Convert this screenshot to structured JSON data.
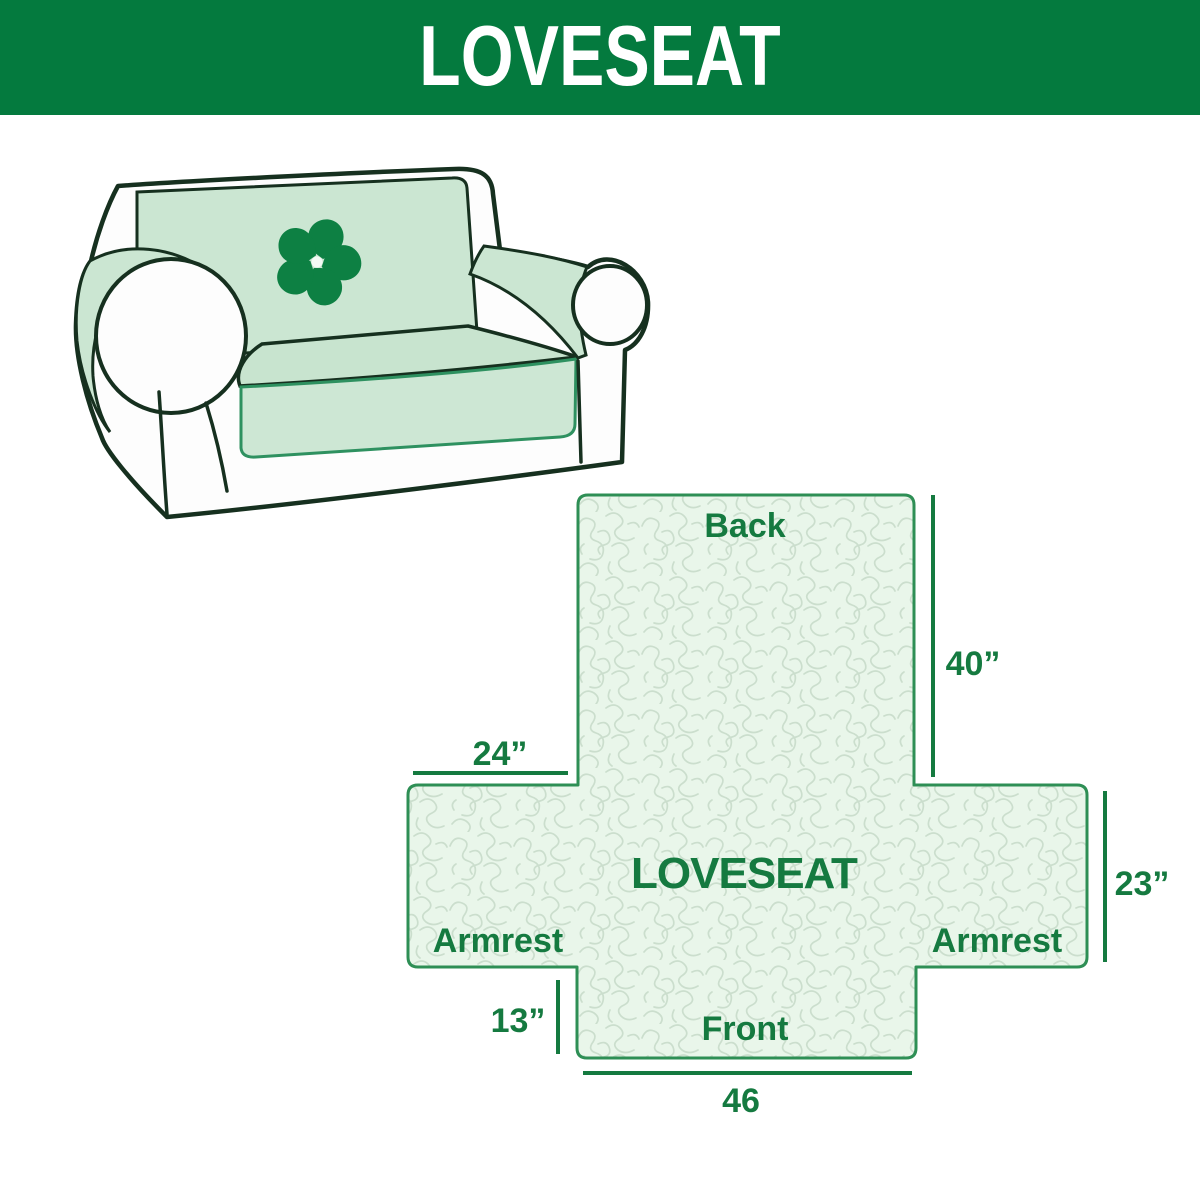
{
  "header": {
    "title": "LOVESEAT"
  },
  "illustration": {
    "alt": "loveseat sofa with mint protective slipcover",
    "logo_icon": "pinwheel-icon"
  },
  "diagram": {
    "back_label": "Back",
    "center_label": "LOVESEAT",
    "armrest_left_label": "Armrest",
    "armrest_right_label": "Armrest",
    "front_label": "Front",
    "dim_back_height": "40”",
    "dim_armrest_top_width": "24”",
    "dim_armrest_side_height": "23”",
    "dim_front_drop": "13”",
    "dim_front_width": "46"
  },
  "colors": {
    "header_green": "#047a3e",
    "header_text": "#ffffff",
    "label_green": "#157a40",
    "diagram_outline_green": "#2e8f55",
    "diagram_fill_light_green": "#e9f6ea",
    "pattern_line_green": "#cbdecd",
    "cover_mint": "#cbe6d2",
    "sofa_outline_dark": "#16301f",
    "cover_edge_green": "#2e9160",
    "logo_green": "#0d8043"
  }
}
